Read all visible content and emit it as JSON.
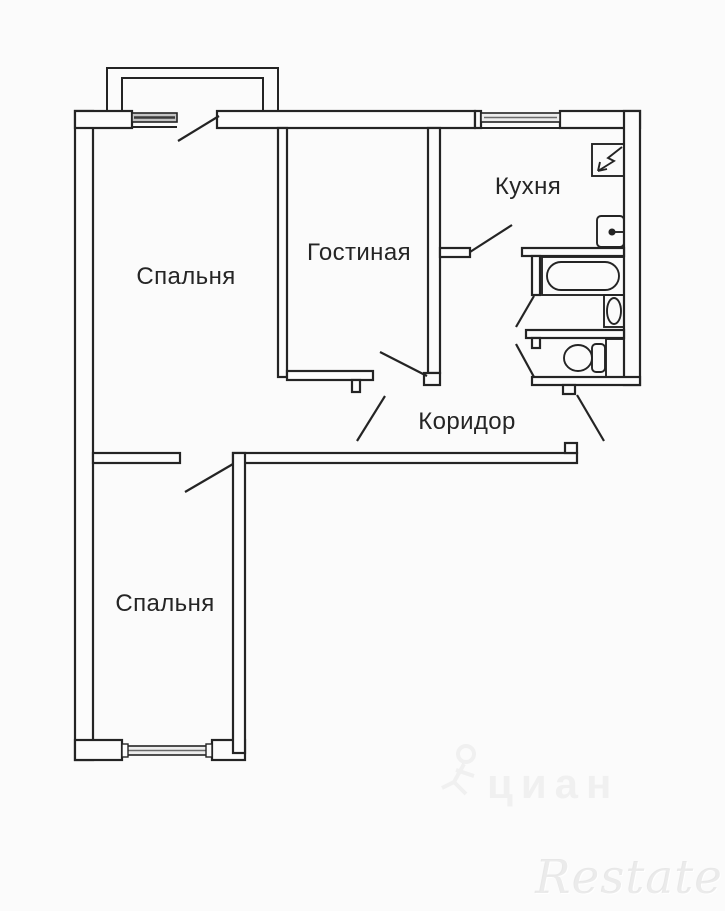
{
  "floorplan": {
    "labels": {
      "bedroom_top": "Спальня",
      "living_room": "Гостиная",
      "kitchen": "Кухня",
      "corridor": "Коридор",
      "bedroom_bottom": "Спальня"
    },
    "watermarks": {
      "portal": "циан",
      "agency": "Restate"
    },
    "colors": {
      "wall_line": "#242424",
      "background": "#fbfbfb",
      "label_text": "#252525",
      "window_fill": "#c4c4c4",
      "watermark_gray": "#e6e6e6"
    }
  }
}
